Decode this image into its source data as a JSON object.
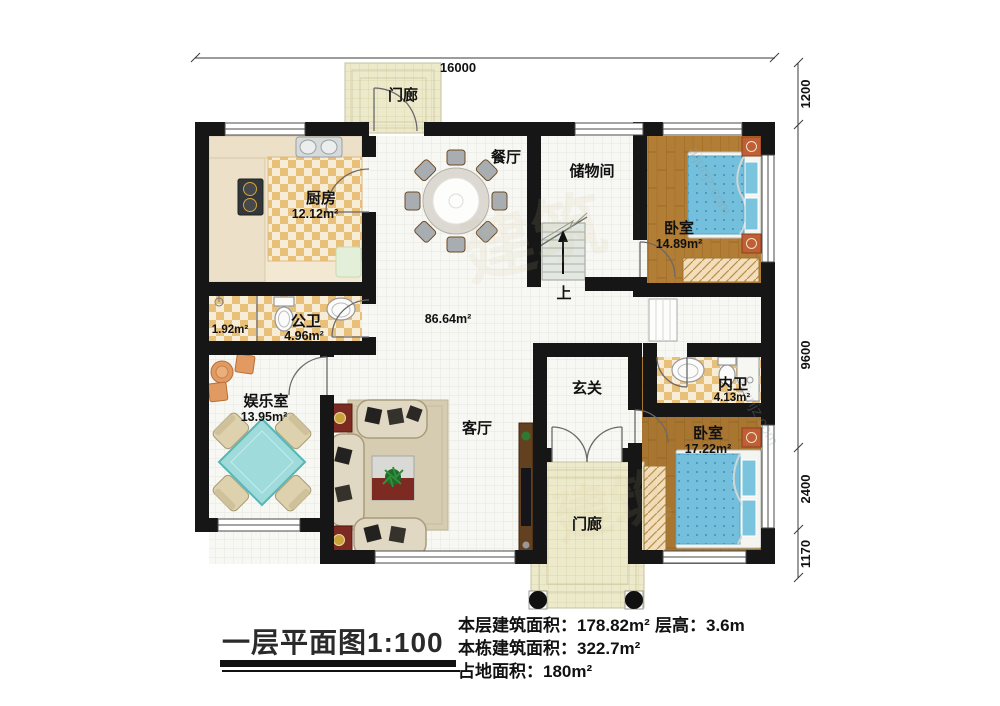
{
  "watermark": {
    "cn": "建筑",
    "site": "aijunjz.com"
  },
  "dimensions": {
    "top": "16000",
    "right_top": "1200",
    "right_middle": "9600",
    "right_lower": "2400",
    "right_bottom": "1170"
  },
  "labels": {
    "porch_top": "门廊",
    "kitchen": "厨房",
    "kitchen_area": "12.12m²",
    "dining": "餐厅",
    "storage": "储物间",
    "bedroom1": "卧室",
    "bedroom1_area": "14.89m²",
    "bath_main": "公卫",
    "bath_main_area": "4.96m²",
    "bath_shower_area": "1.92m²",
    "entertainment": "娱乐室",
    "entertainment_area": "13.95m²",
    "living": "客厅",
    "living_area": "86.64m²",
    "foyer": "玄关",
    "bath_en": "内卫",
    "bath_en_area": "4.13m²",
    "bedroom2": "卧室",
    "bedroom2_area": "17.22m²",
    "porch_bottom": "门廊",
    "stairs_up": "上"
  },
  "footer": {
    "title": "一层平面图1:100",
    "floor_area_label": "本层建筑面积：",
    "floor_area_value": "178.82m²",
    "building_area_label": "本栋建筑面积：",
    "building_area_value": "322.7m²",
    "land_area_label": "占地面积：",
    "land_area_value": "180m²",
    "height_label": "层高：",
    "height_value": "3.6m"
  }
}
